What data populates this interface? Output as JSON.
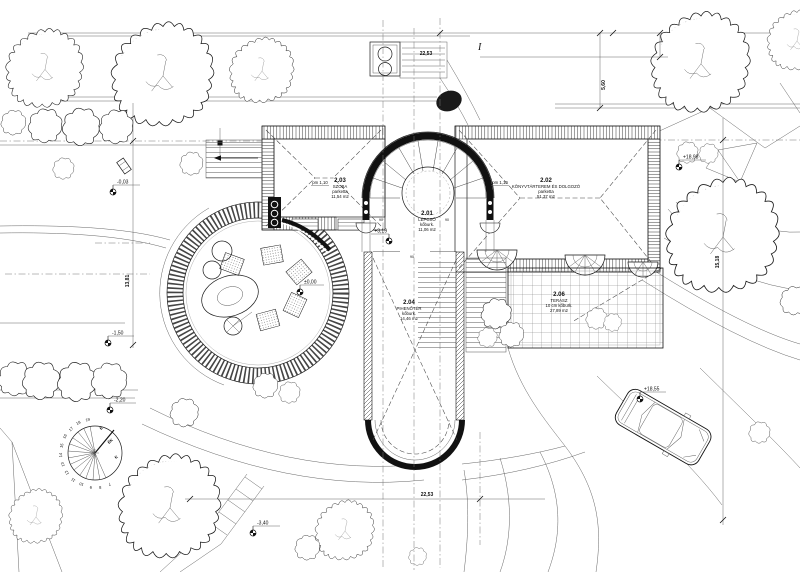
{
  "drawing_colors": {
    "ink": "#1a1a1a",
    "paper": "#ffffff",
    "hatch": "#555555"
  },
  "rooms": [
    {
      "num": "2.03",
      "name": "SZOBA",
      "finish": "parketta",
      "area": "11,54 m2"
    },
    {
      "num": "2.02",
      "name": "KÖNYVTÁRTEREM ÉS DOLGOZÓ",
      "finish": "parketta",
      "area": "51,37 m2"
    },
    {
      "num": "2.01",
      "name": "LÉPCSŐ",
      "finish": "kőburk.",
      "area": "11,06 m2"
    },
    {
      "num": "2.04",
      "name": "PIHENŐTÉR",
      "finish": "kőburk.",
      "area": "14,46 m2"
    },
    {
      "num": "2.06",
      "name": "TERASZ",
      "finish": "10 cm kőburk.",
      "area": "27,89 m2"
    }
  ],
  "dimensions": {
    "top": "22,53",
    "bottom": "22,53",
    "right_upper": "5,60",
    "right_side": "15,18",
    "left_side": "13,81"
  },
  "elevation_markers": [
    "-0,03",
    "±0,00",
    "+3,19",
    "-1,50",
    "-2,20",
    "-3,40",
    "+18,98",
    "+18,55"
  ],
  "window_sills": {
    "left": "pm 1,10",
    "right": "pm 1,10"
  },
  "door_widths": {
    "left": "90",
    "right": "90",
    "bottom": "90"
  },
  "section_mark": "I",
  "sun_diagram": {
    "hours": [
      "19",
      "18",
      "17",
      "16",
      "15",
      "14",
      "13",
      "12",
      "11",
      "10",
      "9",
      "8",
      "7"
    ],
    "directions": [
      "É",
      "ÉK",
      "K"
    ]
  }
}
